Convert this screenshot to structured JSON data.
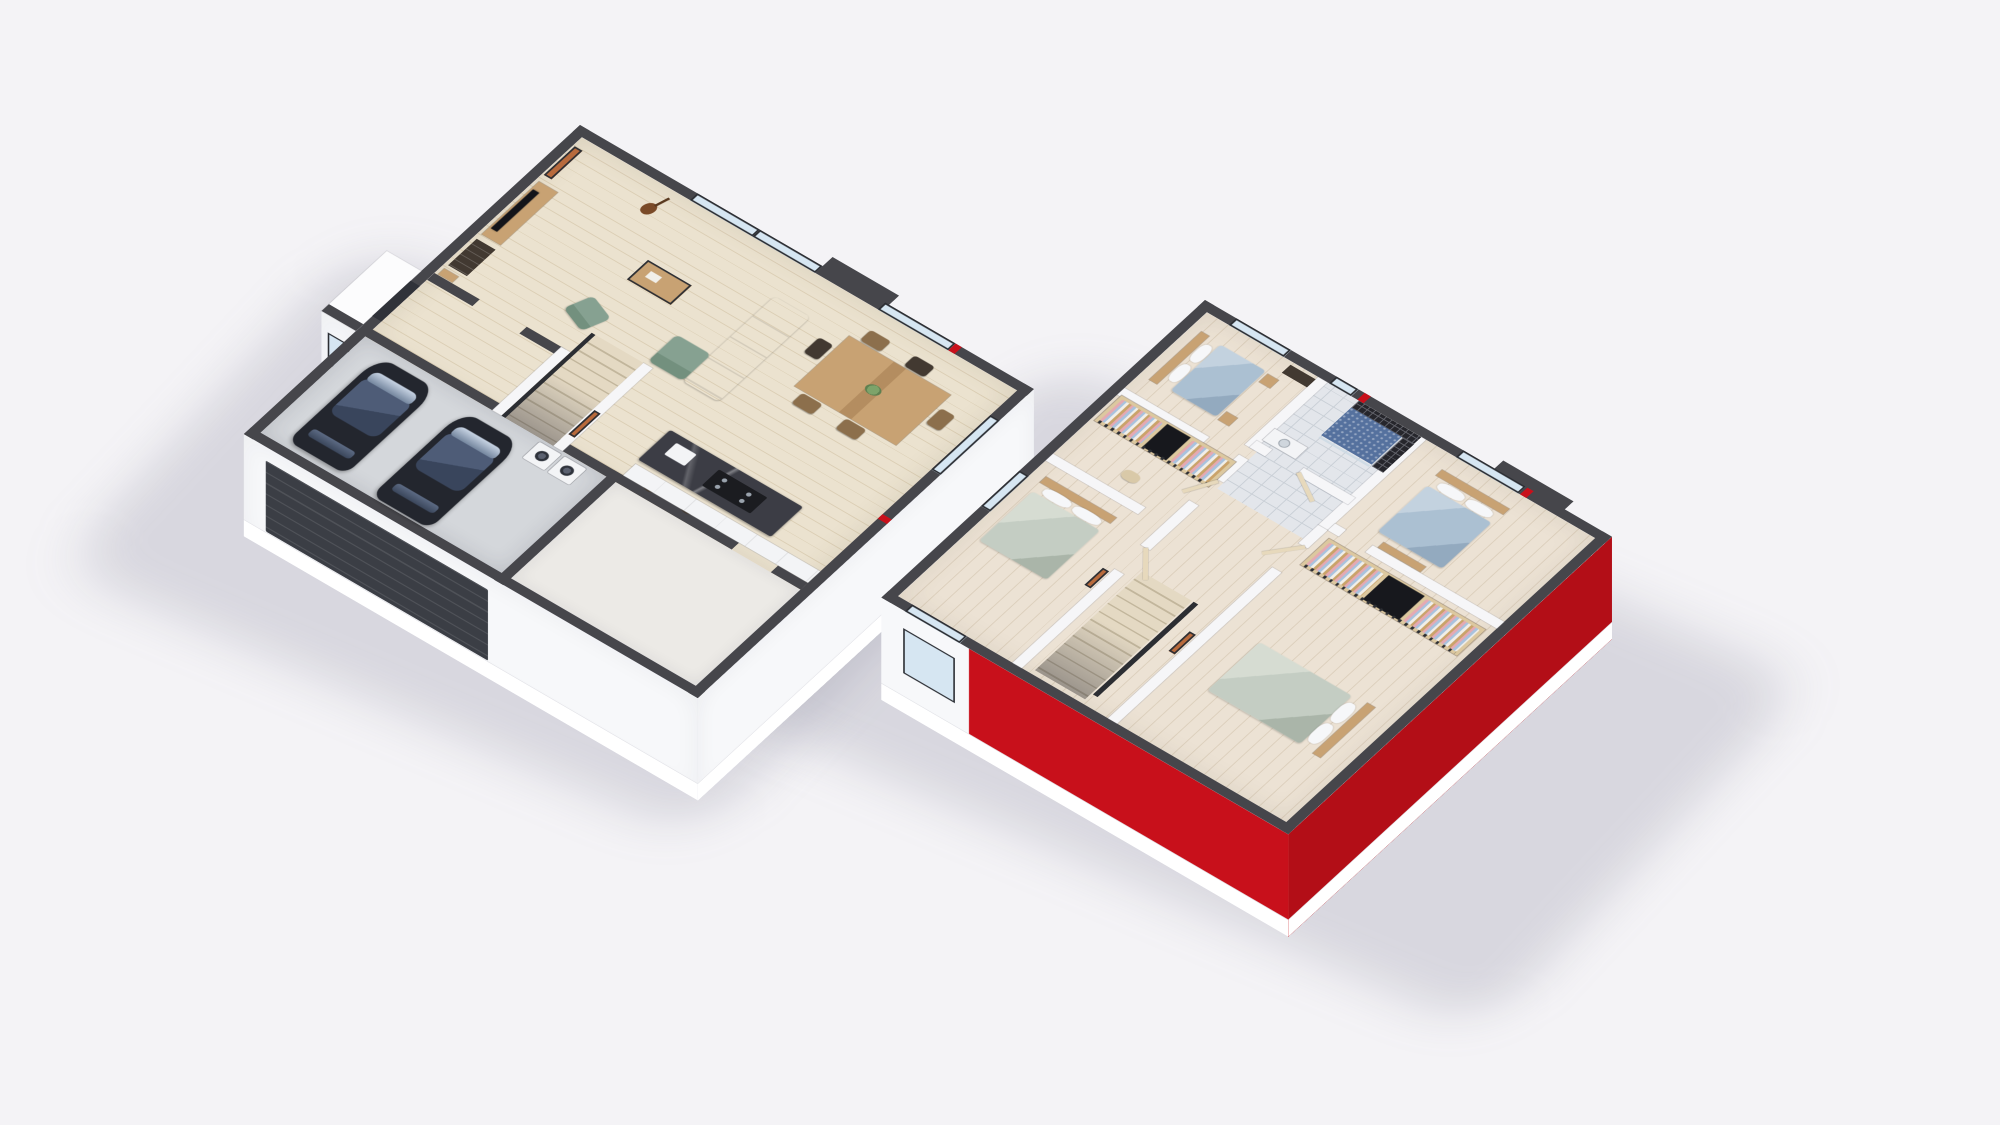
{
  "meta": {
    "description": "3D isometric cutaway floor-plan rendering of a two-storey house, two floors shown side by side on a plain light background",
    "visible_text": []
  },
  "palette": {
    "background": "#f4f3f6",
    "shadow": "rgba(104,104,128,0.20)",
    "wall_top": "#46464b",
    "wall_interior_top": "#f6f6f8",
    "wall_white": "#fcfcfd",
    "face_white": "#f7f8fa",
    "slab_white": "#ffffff",
    "accent_red": "#c8101b",
    "accent_red_deep": "#b30e17",
    "wood_floor": "#ebe2cf",
    "wood_floor_line": "#dbceb4",
    "upper_floor": "#ece2d4",
    "upper_floor_line": "#dccfbc",
    "garage_floor": "#d4d7db",
    "pantry_floor": "#eceae6",
    "tile_floor": "#e3e6eb",
    "tile_line": "#c9cfd6",
    "shower_tile_dark": "#26262c",
    "shower_grout": "#62636b",
    "shower_mosaic": "#55719e",
    "glass": "#d6e6f2",
    "frame_dark": "#2c2e33",
    "door_dark": "#303239",
    "garage_door": "#3b3e45",
    "sofa_green": "#86a191",
    "sofa_green_dark": "#73907e",
    "bed_blue": "#abc0d2",
    "bed_sage": "#c4cdc3",
    "pillow_white": "#f6f7f9",
    "wood": "#c8a273",
    "wood_dark": "#8c6f4c",
    "furniture_dark": "#423931",
    "marble_dark": "#3c3d45",
    "car_body": "#23262e",
    "car_glass": "#4e5c77",
    "stairs_wood": "#e4d9c3",
    "stair_line": "#c2b69c",
    "appliance_white": "#f3f4f6",
    "art_warm": "#b86a3c",
    "cloth_pink": "#e5a9b2",
    "cloth_blue": "#a9c2de",
    "cloth_white": "#f1efe9",
    "plant_green": "#7da36a"
  },
  "floors": [
    {
      "id": "ground-floor",
      "position": "left",
      "exterior_wall_color": "white",
      "rooms": [
        {
          "name": "living-room",
          "floor": "light wood planks",
          "furniture": [
            "wall-art",
            "media-console",
            "tv",
            "bookshelf",
            "decor-shelf",
            "guitar",
            "green-sectional-sofa",
            "coffee-table",
            "green-armchair"
          ]
        },
        {
          "name": "dining-area",
          "floor": "light wood planks",
          "furniture": [
            "wood-dining-table",
            "six-chairs",
            "plant-centerpiece"
          ],
          "windows": [
            "large glazed sliding doors on two walls"
          ]
        },
        {
          "name": "kitchen",
          "floor": "light wood planks",
          "furniture": [
            "dark-marble-island",
            "hob",
            "sink",
            "two-bar-stools",
            "white-counter"
          ]
        },
        {
          "name": "staircase",
          "furniture": [
            "wood-stairs",
            "dark-handrail",
            "wall-art"
          ]
        },
        {
          "name": "entrance-hall",
          "furniture": [
            "dark-front-door",
            "porch",
            "porch-window"
          ]
        },
        {
          "name": "garage",
          "floor": "grey concrete",
          "furniture": [
            "black-car",
            "black-car",
            "washing-machine",
            "tumble-dryer",
            "dark-sectional-garage-door"
          ]
        },
        {
          "name": "storage-room",
          "furniture": []
        }
      ]
    },
    {
      "id": "upper-floor",
      "position": "right",
      "exterior_wall_color": "white with red accent walls on front and side",
      "rooms": [
        {
          "name": "bedroom-1",
          "furniture": [
            "double-bed-blue",
            "wood-headboard-shelves",
            "two-side-tables",
            "dark-dresser"
          ],
          "windows": [
            "north window"
          ]
        },
        {
          "name": "bathroom",
          "furniture": [
            "dark-mosaic-shower-wall",
            "blue-mosaic-shower-floor",
            "glass-screen",
            "white-vanity"
          ],
          "windows": [
            "small north window"
          ]
        },
        {
          "name": "bedroom-2",
          "furniture": [
            "double-bed-blue",
            "foot-bench"
          ],
          "windows": [
            "north window"
          ]
        },
        {
          "name": "walk-in-closet",
          "furniture": [
            "wardrobe-with-clothes",
            "dark-panel",
            "shoe-shelf",
            "ottoman"
          ]
        },
        {
          "name": "bedroom-3",
          "furniture": [
            "double-bed-sage",
            "wall-art"
          ],
          "windows": [
            "south window",
            "west window"
          ]
        },
        {
          "name": "landing",
          "furniture": [
            "wood-stairs",
            "dark-handrail",
            "wall-art",
            "open-doors"
          ]
        },
        {
          "name": "bedroom-4",
          "furniture": [
            "double-bed-sage",
            "wardrobe-with-clothes"
          ]
        }
      ]
    }
  ]
}
